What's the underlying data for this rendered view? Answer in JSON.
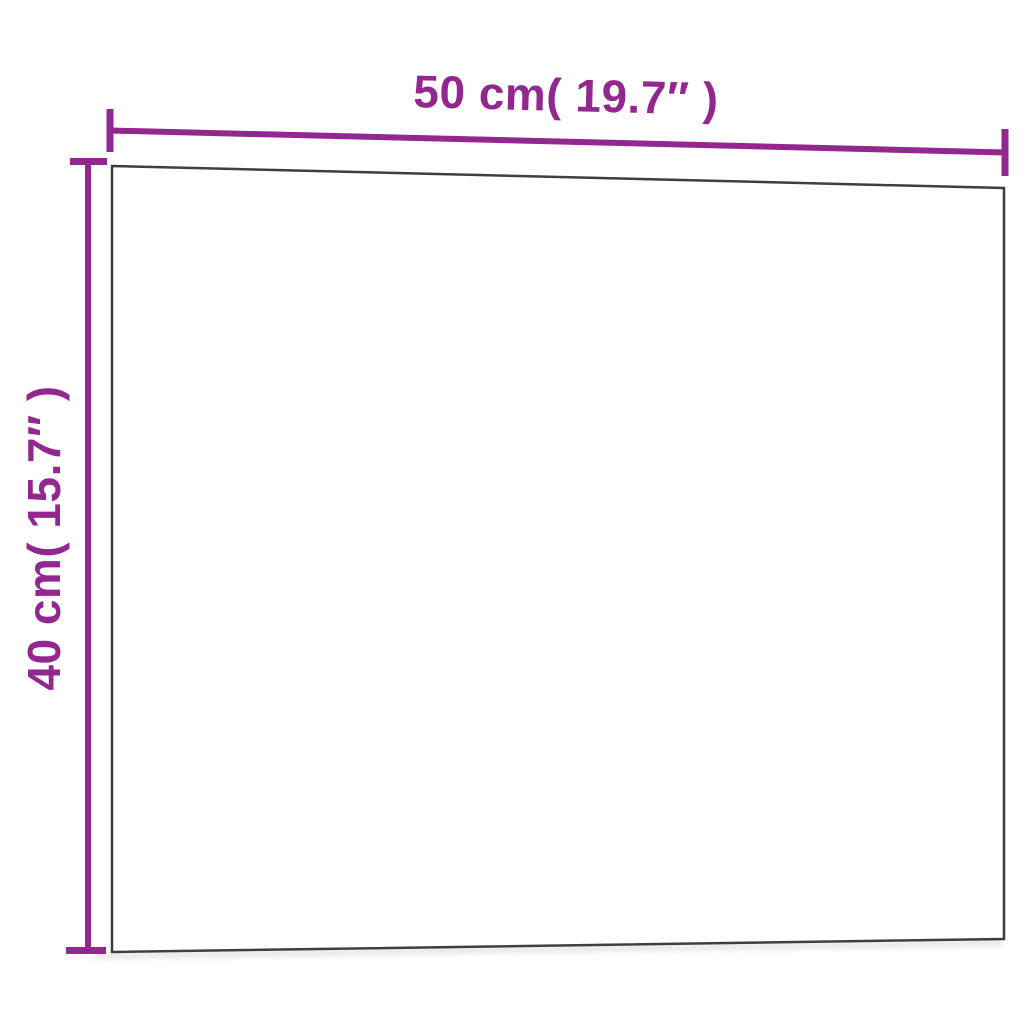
{
  "dimensions": {
    "width": {
      "label": "50 cm( 19.7″ )",
      "cm": 50,
      "inches": 19.7
    },
    "height": {
      "label": "40 cm( 15.7″ )",
      "cm": 40,
      "inches": 15.7
    }
  },
  "colors": {
    "dimension_color": "#92278f",
    "board_border_color": "#3f3f3f",
    "board_fill": "#ffffff",
    "background": "#ffffff",
    "shadow_color": "#bcbcbc"
  }
}
